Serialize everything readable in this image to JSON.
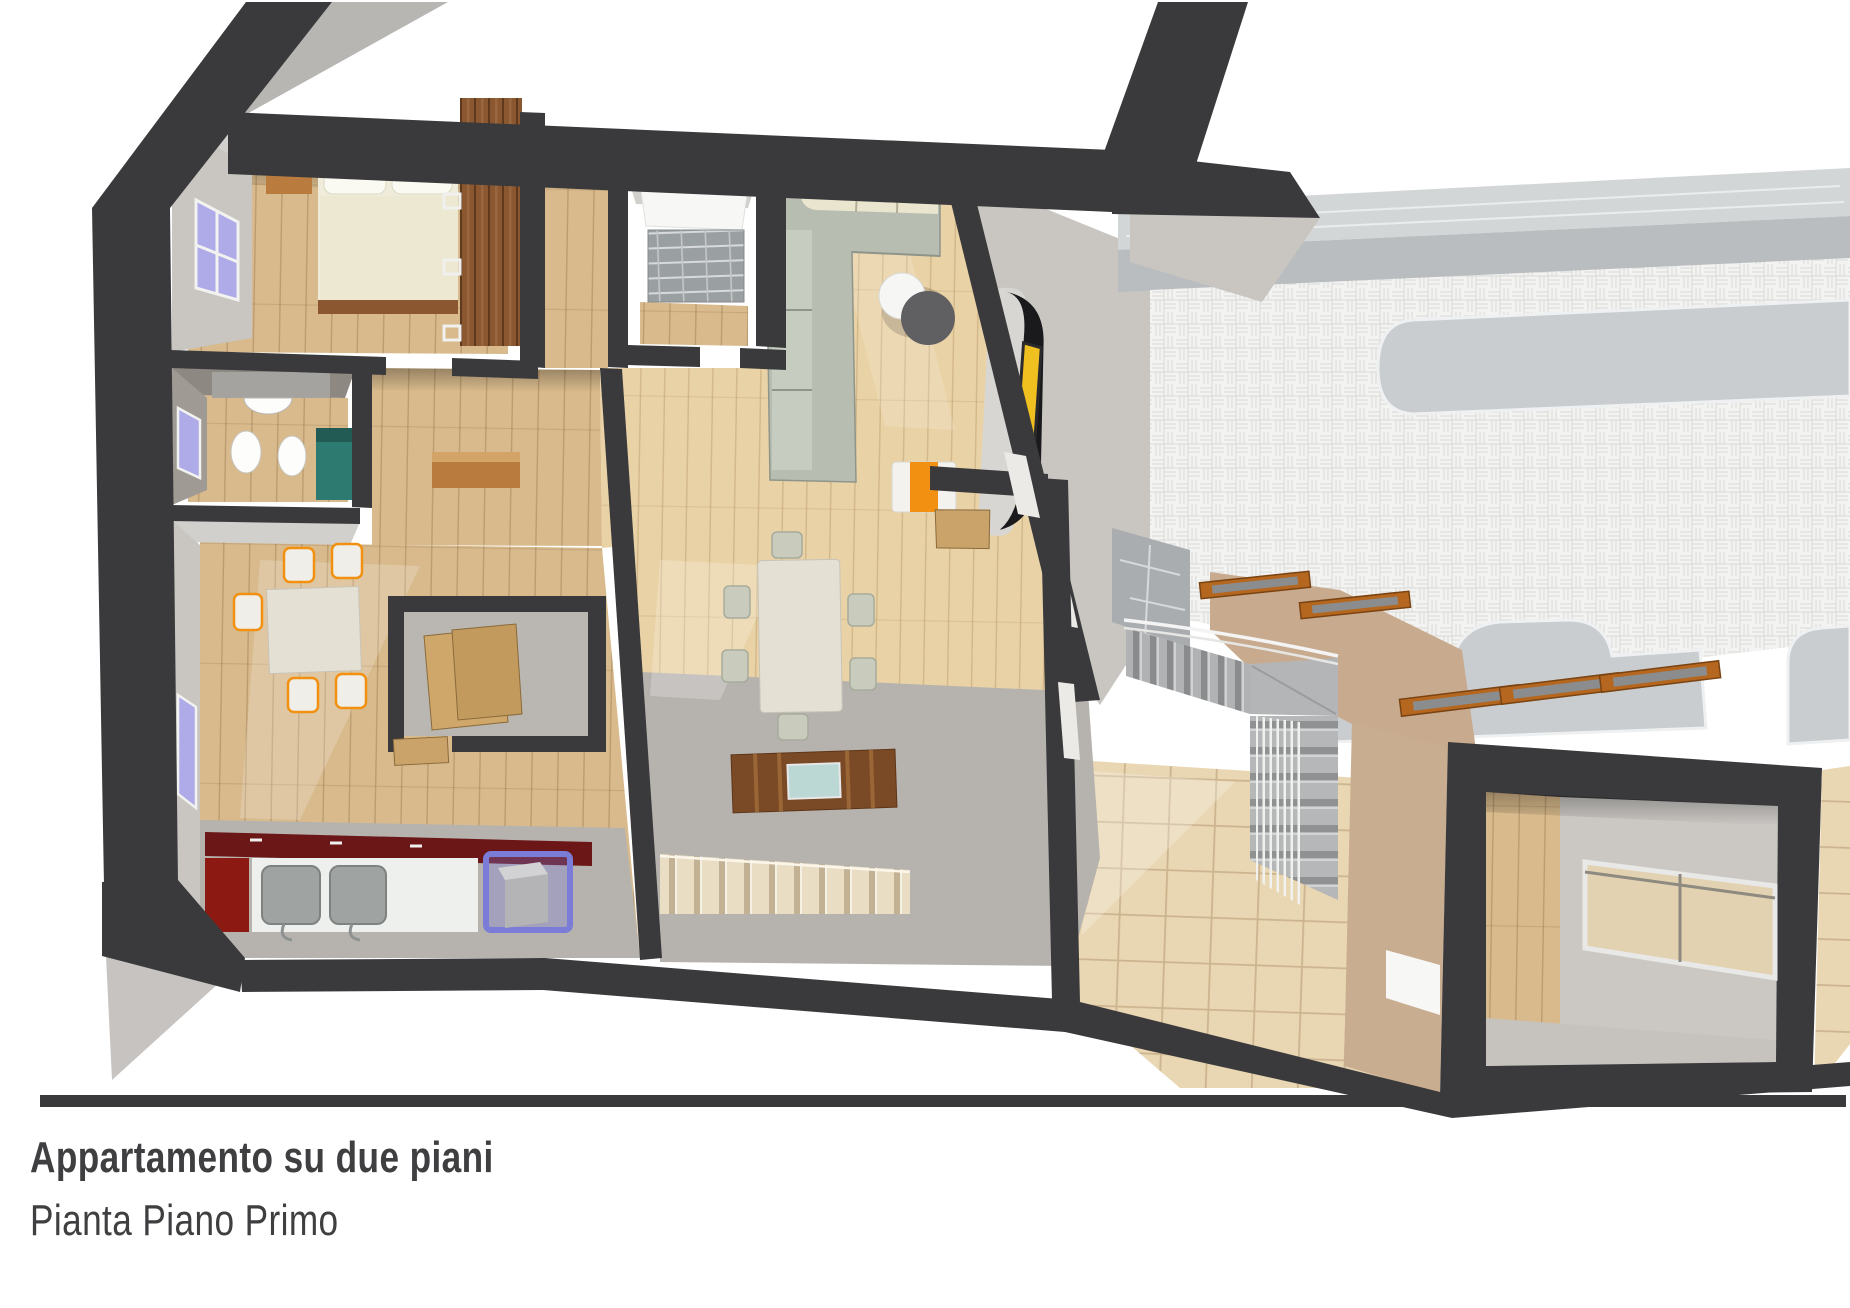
{
  "title_block": {
    "title": "Appartamento su due piani",
    "subtitle": "Pianta Piano Primo"
  },
  "palette": {
    "wall_dark": "#3a3a3c",
    "wall_face_light": "#c9c6c2",
    "wall_face_mid": "#b5b2ae",
    "ceiling_gray": "#d2d0cc",
    "floor_wood": "#d8ba8c",
    "floor_wood_pale": "#e9d2a6",
    "floor_gray": "#b6b3af",
    "terrace_tile_white": "#f3f3f2",
    "terrace_tile_line": "#d8d8d5",
    "stone_gray": "#c9cdcf",
    "stone_rim": "#eef0f1",
    "flagstone_gray": "#a9adb0",
    "tan_tile": "#e9d6b2",
    "tan_tile_line": "#cbb48e",
    "roof_tan": "#c8ab8e",
    "roof_tan_side": "#c9ad90",
    "skylight_wood": "#b5671f",
    "sofa_sage": "#b7bdb0",
    "sofa_cream": "#e9e5cf",
    "bed_cream": "#efecdb",
    "wood_furniture": "#b97c3e",
    "wardrobe_brown": "#8a5730",
    "counter_red": "#6b1717",
    "accent_orange": "#f29111",
    "glass_blue": "#aeabe8",
    "glass_cube_blue": "#7b7bd8",
    "teal": "#2c7a70",
    "tv_black": "#1a1a1d",
    "tv_screen_yellow": "#f0c020",
    "table_cream": "#e5e0d4",
    "marble_step": "#e9ddc4",
    "text_dark": "#3f3f41",
    "rule_dark": "#3a3a3c"
  }
}
